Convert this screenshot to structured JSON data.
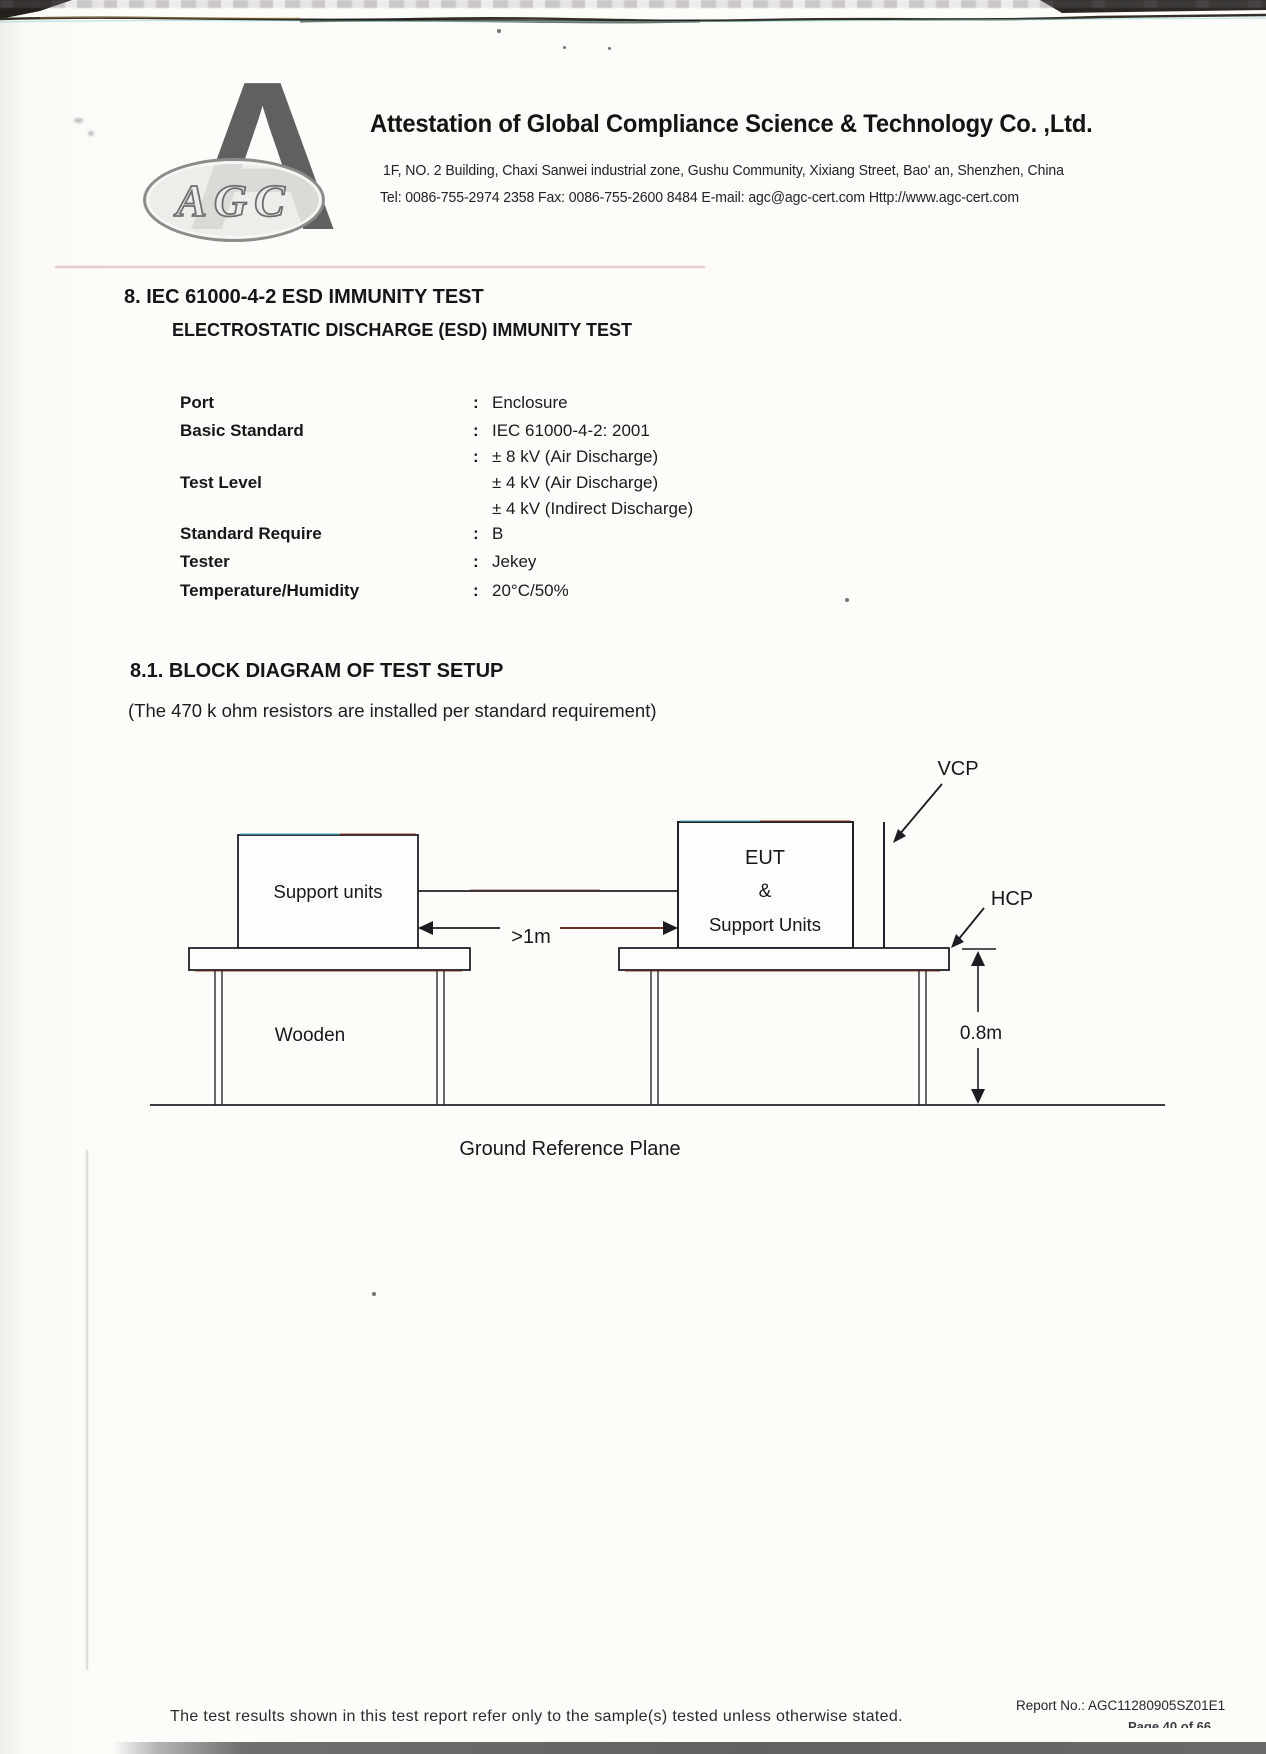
{
  "colors": {
    "ink": "#1b1b1b",
    "scan_bar_gray": "#6f6f6f",
    "logo_gray": "#525254"
  },
  "header": {
    "logo": {
      "letter": "A",
      "oval_text": "AGC"
    },
    "company_name": "Attestation of Global Compliance Science & Technology Co. ,Ltd.",
    "address_line": "1F, NO. 2 Building, Chaxi Sanwei industrial zone, Gushu Community, Xixiang Street, Bao' an, Shenzhen, China",
    "contact_line": "Tel: 0086-755-2974 2358  Fax: 0086-755-2600 8484  E-mail: agc@agc-cert.com  Http://www.agc-cert.com"
  },
  "section8": {
    "title": "8. IEC 61000-4-2 ESD IMMUNITY TEST",
    "subtitle": "ELECTROSTATIC DISCHARGE (ESD) IMMUNITY TEST",
    "param_rows": [
      {
        "label": "Port",
        "colon": ":",
        "value": "Enclosure"
      },
      {
        "label": "Basic Standard",
        "colon": ":",
        "value": "IEC 61000-4-2: 2001"
      },
      {
        "label": "",
        "colon": ":",
        "value": "± 8 kV (Air Discharge)"
      },
      {
        "label": "Test Level",
        "colon": "",
        "value": "± 4 kV (Air Discharge)"
      },
      {
        "label": "",
        "colon": "",
        "value": "± 4 kV (Indirect Discharge)"
      },
      {
        "label": "Standard Require",
        "colon": ":",
        "value": "B"
      },
      {
        "label": "Tester",
        "colon": ":",
        "value": "Jekey"
      },
      {
        "label": "Temperature/Humidity",
        "colon": ":",
        "value": "20°C/50%"
      }
    ]
  },
  "section81": {
    "title": "8.1. BLOCK DIAGRAM OF TEST SETUP",
    "note": "(The 470 k ohm resistors are installed per standard requirement)"
  },
  "diagram": {
    "vcp_label": "VCP",
    "hcp_label": "HCP",
    "eut_box": {
      "line1": "EUT",
      "line2": "&",
      "line3": "Support Units"
    },
    "support_box_label": "Support units",
    "distance_label": ">1m",
    "height_label": "0.8m",
    "table_label": "Wooden",
    "ground_label": "Ground Reference Plane"
  },
  "footer": {
    "disclaimer": "The test results shown in this test report refer only to the sample(s) tested unless otherwise stated.",
    "report_no": "Report No.: AGC11280905SZ01E1",
    "page_fragment": "Page 40 of 66"
  }
}
